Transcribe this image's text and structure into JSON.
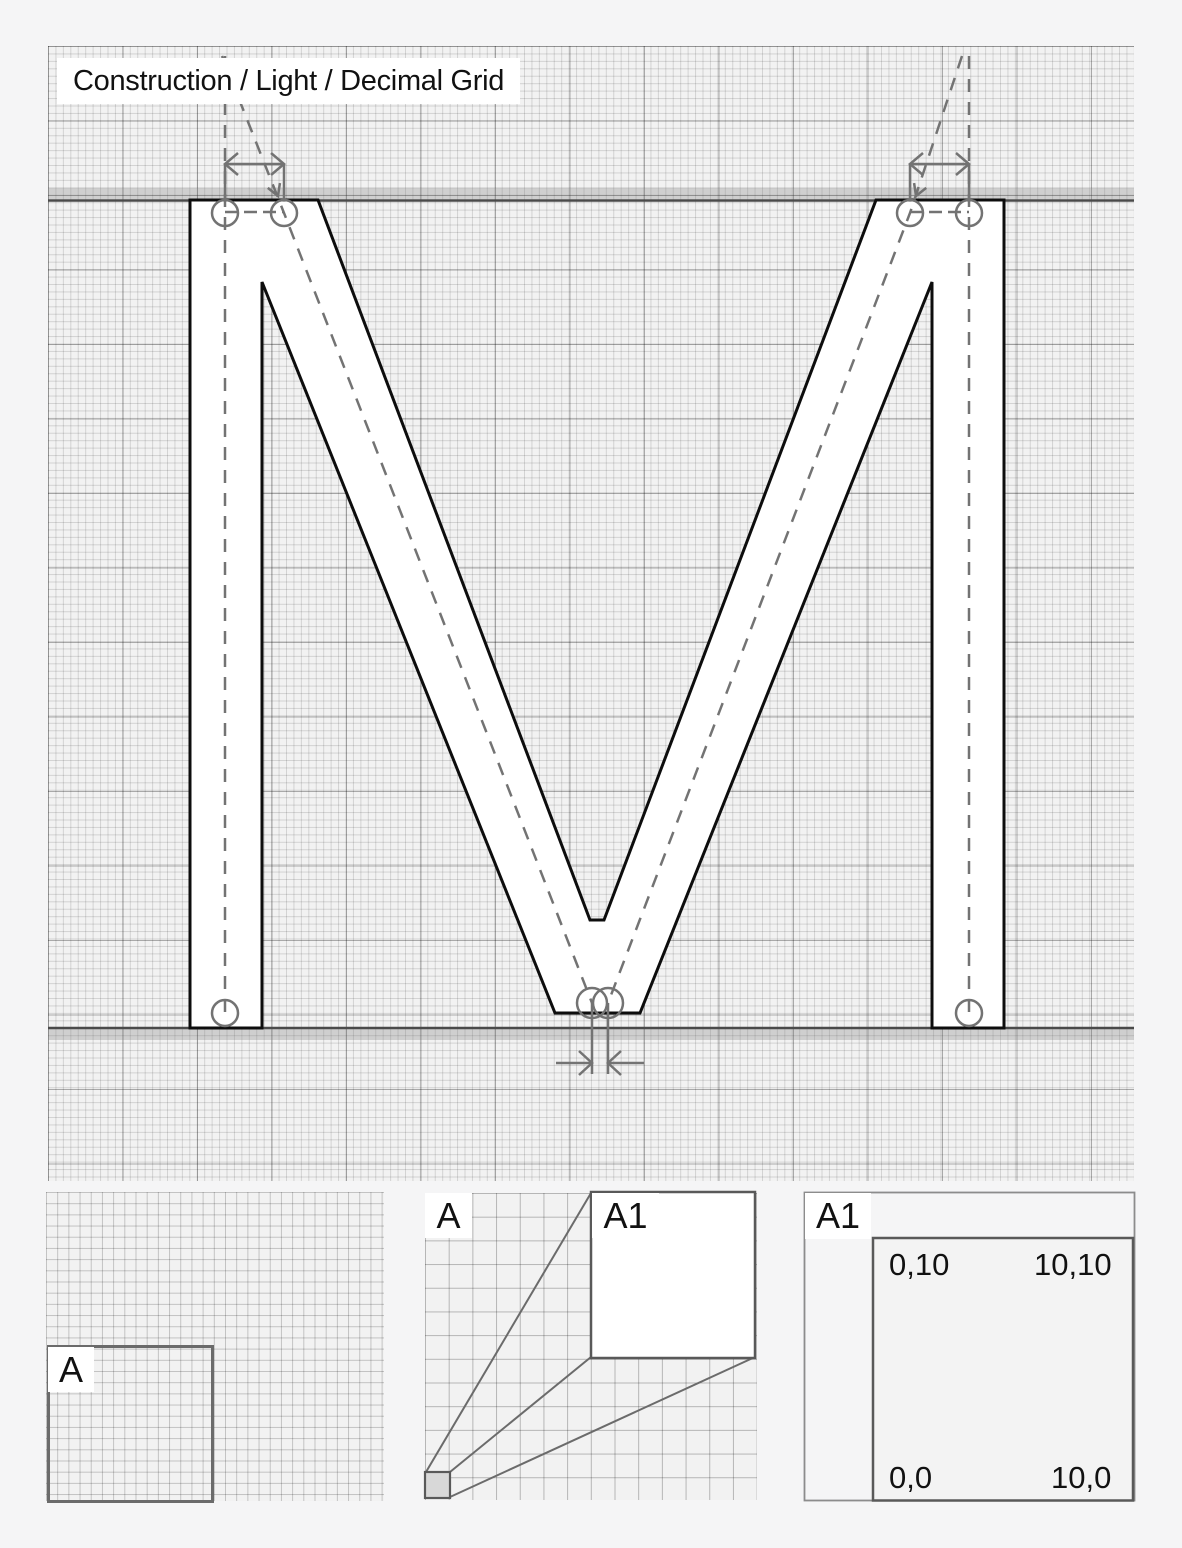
{
  "title": "Construction / Light / Decimal Grid",
  "glyph": {
    "letter": "M"
  },
  "panels": {
    "overview": {
      "label": "A"
    },
    "zoom_map": {
      "source_label": "A",
      "target_label": "A1"
    },
    "detail": {
      "label": "A1",
      "corners": {
        "top_left": "0,10",
        "top_right": "10,10",
        "bottom_left": "0,0",
        "bottom_right": "10,0"
      }
    }
  },
  "colors": {
    "page_bg": "#f5f5f6",
    "grid_cell": "#f2f2f2",
    "grid_minor": "#cfcfcf",
    "grid_major": "#9b9b9b",
    "glyph_fill": "#ffffff",
    "glyph_stroke": "#0d0d0d",
    "construction": "#737373",
    "guide_band": "#c9c9c9",
    "text": "#111111"
  }
}
